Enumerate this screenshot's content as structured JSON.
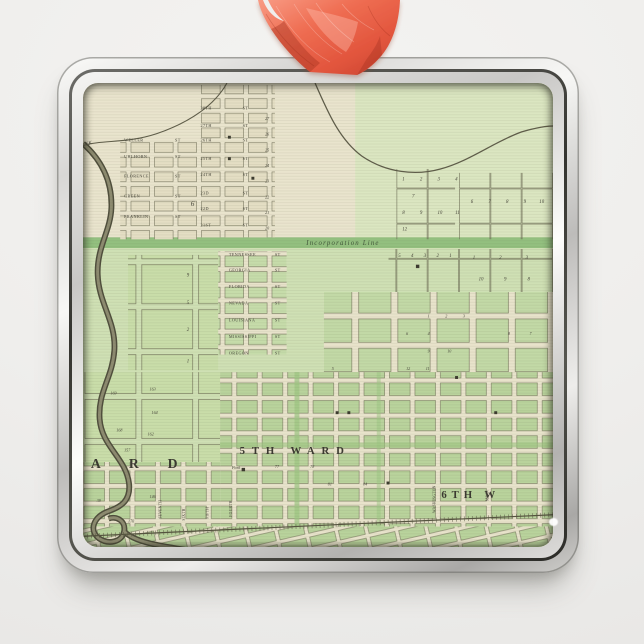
{
  "scene": {
    "description": "square silver metal ornament with antique ward map print, hanging on coral satin ribbon"
  },
  "colors": {
    "page_bg": "#f1f0ee",
    "ribbon": "#ed6a50",
    "frame_silver": "#d9d8d6",
    "map_cream": "#e9e4cd",
    "map_green": "#cfe0b4",
    "band_green": "#93c07f",
    "linework": "#55543f"
  },
  "map": {
    "labels": {
      "incorporation": "Incorporation Line",
      "creek_fragment": "EK",
      "park": "Park",
      "ward_partial_left": "A R D",
      "ward_fifth": "5TH WARD",
      "ward_sixth_partial": "6TH W",
      "big_parcel": "6"
    },
    "street_suffix": "ST",
    "streets_nw": [
      "WELLER",
      "UHLHORN",
      "FLORENCE",
      "GREEN",
      "FRANKLIN"
    ],
    "streets_state": [
      "TENNESSEE",
      "GEORGIA",
      "FLORIDA",
      "NEVADA",
      "LOUISIANA",
      "MISSISSIPPI",
      "OREGON"
    ],
    "streets_cross": [
      "28TH",
      "27TH",
      "26TH",
      "25TH",
      "24TH",
      "23D",
      "22D",
      "21ST"
    ],
    "streets_vertical": [
      "SEVENTH",
      "SIXTH",
      "FIFTH",
      "FOURTH"
    ],
    "streets_vertical_se": [
      "WASHINGTON",
      "MAIN"
    ],
    "block_numbers_column": [
      "27",
      "26",
      "25",
      "24",
      "23",
      "22",
      "21",
      "20"
    ],
    "parcels_top_mid": [
      "1",
      "2",
      "3",
      "4",
      "7",
      "8",
      "9",
      "10",
      "11",
      "12"
    ],
    "parcels_top_right": [
      "6",
      "7",
      "8",
      "9",
      "10"
    ],
    "parcels_below_band": [
      "5",
      "4",
      "3",
      "2",
      "1"
    ],
    "parcels_below_band_right": [
      "1",
      "2",
      "3"
    ],
    "parcels_right_row2": [
      "10",
      "9",
      "8"
    ],
    "parcels_left_mid": [
      "9",
      "5",
      "2",
      "1"
    ],
    "blocks_left": [
      "169",
      "163",
      "164",
      "168",
      "162",
      "157",
      "146",
      "170",
      "39"
    ],
    "blocks_mid": [
      "1",
      "2",
      "3",
      "6",
      "4",
      "8",
      "7",
      "9",
      "10",
      "12",
      "11",
      "5"
    ],
    "blocks_ward5": [
      "77",
      "78",
      "81",
      "84"
    ]
  }
}
